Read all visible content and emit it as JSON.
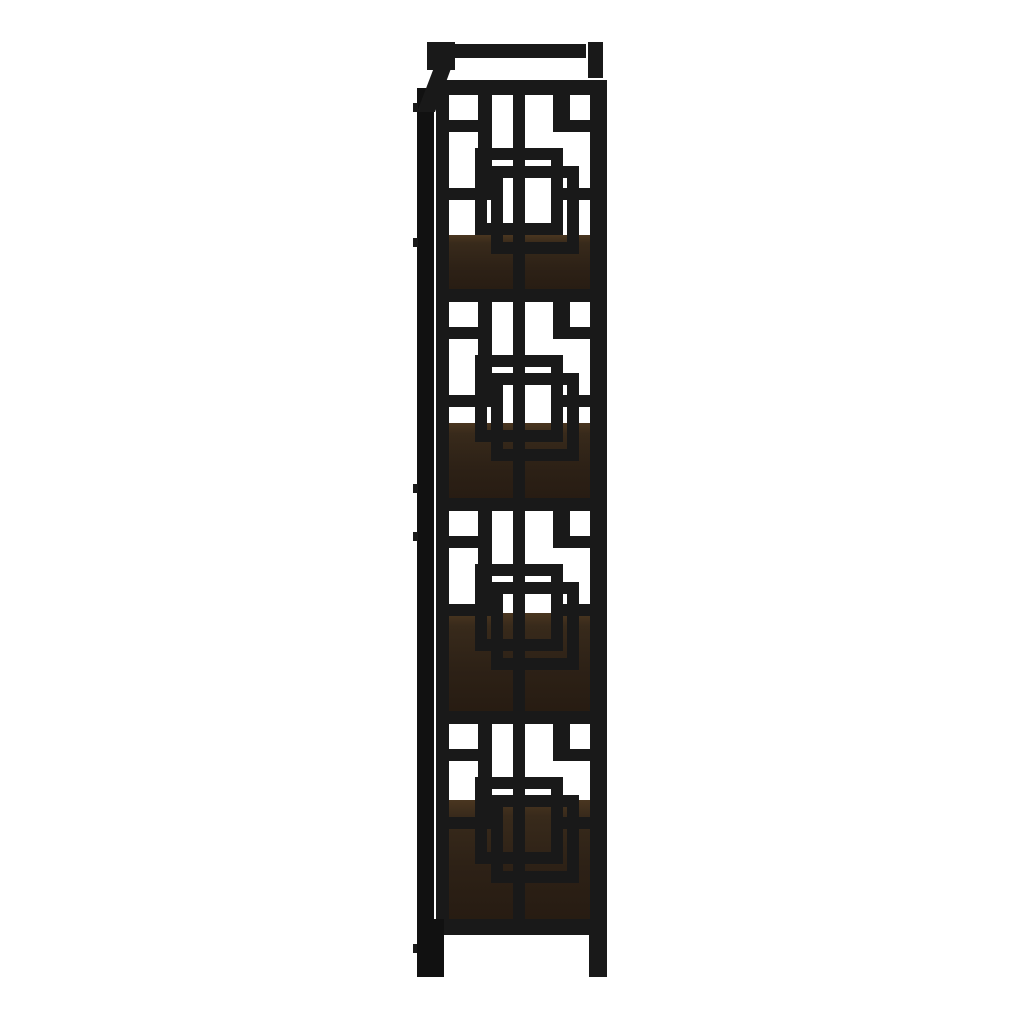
{
  "image": {
    "type": "product-photo",
    "subject": "bookcase side view",
    "description": "Side profile of a 4-shelf etagere bookcase with a black metal frame, decorative interlocking-squares fretwork side panel and dark espresso wood shelves on a white background",
    "orientation": "side-view",
    "shelf_count": 4,
    "pattern": "interlocking-squares-fretwork",
    "materials": [
      "black metal frame",
      "espresso wood shelves"
    ]
  },
  "colors": {
    "background": "#ffffff",
    "frame": "#191919",
    "frame_dark": "#111111",
    "shelf_edge": "#4a3620",
    "shelf_upper": "#382a1b",
    "shelf_mid": "#2d2116",
    "shelf_dark": "#251a11"
  }
}
